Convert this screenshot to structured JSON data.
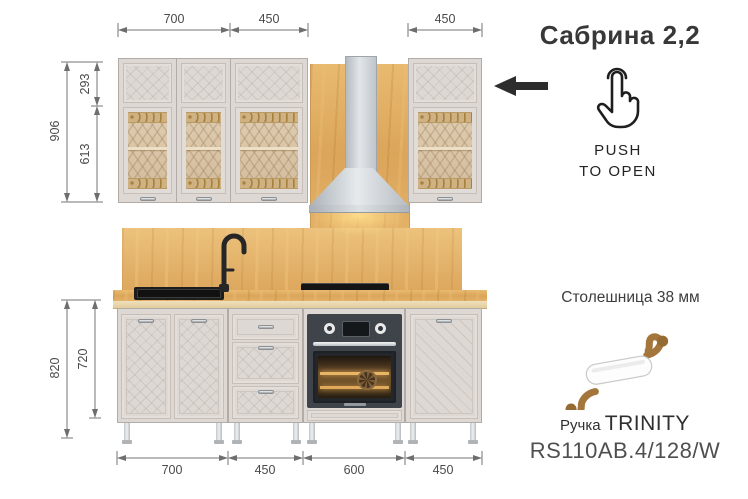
{
  "title": "Сабрина  2,2",
  "push_label": {
    "line1": "PUSH",
    "line2": "TO OPEN"
  },
  "countertop_note": "Столешница 38 мм",
  "handle_info": {
    "prefix": "Ручка",
    "name": "TRINITY",
    "model": "RS110AB.4/128/W"
  },
  "dimensions_mm": {
    "top": [
      "700",
      "450",
      "450"
    ],
    "upper_height": {
      "total": "906",
      "top_section": "293",
      "glass_section": "613"
    },
    "base_height": {
      "total": "820",
      "cabinet": "720"
    },
    "bottom": [
      "700",
      "450",
      "600",
      "450"
    ]
  },
  "icons": {
    "push_hand": "hand-tap-icon",
    "open_direction": "left-arrow-icon",
    "faucet": "faucet-icon"
  },
  "colors": {
    "facade": "#ded8d4",
    "glass_tint": "#d9c5a9",
    "wood": "#dfa95e",
    "hood_steel": "#c9ced2",
    "oven_body": "#3f444b",
    "text": "#3a3a3a"
  }
}
